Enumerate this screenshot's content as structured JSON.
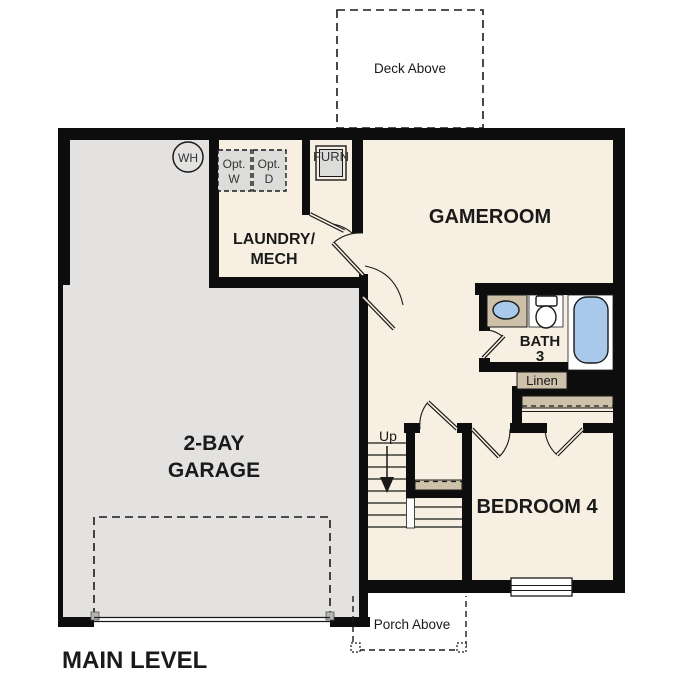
{
  "plan": {
    "title": "MAIN LEVEL",
    "rooms": {
      "garage": {
        "line1": "2-BAY",
        "line2": "GARAGE"
      },
      "gameroom": {
        "label": "GAMEROOM"
      },
      "laundry": {
        "line1": "LAUNDRY/",
        "line2": "MECH"
      },
      "bath": {
        "line1": "BATH",
        "line2": "3"
      },
      "bedroom": {
        "label": "BEDROOM 4"
      },
      "linen": {
        "label": "Linen"
      }
    },
    "outdoor": {
      "deck": "Deck Above",
      "porch": "Porch Above"
    },
    "stairs": {
      "direction": "Up"
    },
    "equipment": {
      "water_heater": "WH",
      "furnace": "FURN",
      "washer": {
        "line1": "Opt.",
        "line2": "W"
      },
      "dryer": {
        "line1": "Opt.",
        "line2": "D"
      }
    },
    "colors": {
      "wall": "#0d0d0d",
      "floor": "#f7f0e2",
      "garage_floor": "#e3e2e0",
      "fixture_tan": "#cdc1a9",
      "fixture_blue": "#a9c9eb",
      "equipment_gray": "#dcdcda"
    }
  }
}
